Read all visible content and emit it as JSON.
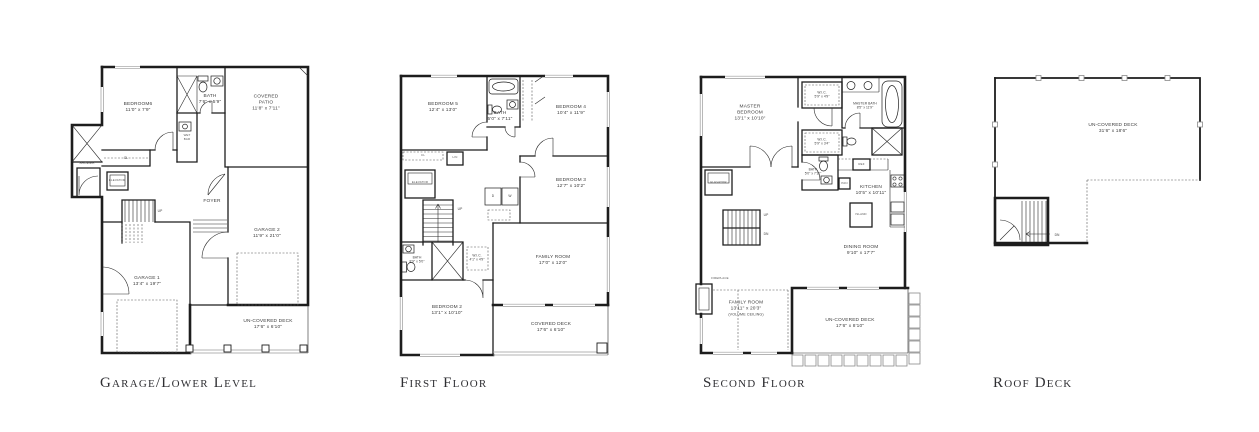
{
  "plans": {
    "garage_lower": {
      "title": "Garage/Lower Level",
      "rooms": {
        "bedroom6": {
          "name": "BEDROOM6",
          "dims": "11'0\" x 7'9\""
        },
        "bath": {
          "name": "BATH",
          "dims": "7'6\" x 5'9\""
        },
        "covered_patio": {
          "name": "COVERED PATIO",
          "dims": "11'8\" x 7'11\""
        },
        "foyer": {
          "name": "FOYER"
        },
        "garage1": {
          "name": "GARAGE 1",
          "dims": "13'4\" x 19'7\""
        },
        "garage2": {
          "name": "GARAGE 2",
          "dims": "11'9\" x 21'0\""
        },
        "uncovered_deck": {
          "name": "UN-COVERED DECK",
          "dims": "17'6\" x 6'10\""
        },
        "shower": {
          "name": "SHOWER"
        },
        "elevator": {
          "name": "ELEVATOR"
        },
        "wet_bar": {
          "name": "WET BAR"
        },
        "closet": {
          "name": "CL"
        },
        "up": {
          "name": "UP"
        }
      }
    },
    "first_floor": {
      "title": "First Floor",
      "rooms": {
        "bedroom5": {
          "name": "BEDROOM 5",
          "dims": "12'4\" x 13'0\""
        },
        "bath_upper": {
          "name": "BATH",
          "dims": "5'0\" x 7'11\""
        },
        "bedroom4": {
          "name": "BEDROOM 4",
          "dims": "10'4\" x 11'9\""
        },
        "bedroom3": {
          "name": "BEDROOM 3",
          "dims": "12'7\" x 10'2\""
        },
        "bedroom2": {
          "name": "BEDROOM 2",
          "dims": "13'1\" x 10'10\""
        },
        "family_room": {
          "name": "FAMILY ROOM",
          "dims": "17'0\" x 12'0\""
        },
        "covered_deck": {
          "name": "COVERED DECK",
          "dims": "17'6\" x 6'10\""
        },
        "bath_lower": {
          "name": "BATH",
          "dims": "8'9\" x 5'0\""
        },
        "wic": {
          "name": "W.I.C.",
          "dims": "4'1\" x 4'9\""
        },
        "linen": {
          "name": "LIN"
        },
        "closet": {
          "name": "CL"
        },
        "elevator": {
          "name": "ELEVATOR"
        },
        "dryer": {
          "name": "D"
        },
        "washer": {
          "name": "W"
        },
        "up": {
          "name": "UP"
        }
      }
    },
    "second_floor": {
      "title": "Second Floor",
      "rooms": {
        "master_bedroom": {
          "name": "MASTER BEDROOM",
          "dims": "13'1\" x 10'10\""
        },
        "wic1": {
          "name": "W.I.C.",
          "dims": "5'9\" x 4'9\""
        },
        "master_bath": {
          "name": "MASTER BATH",
          "dims": "8'5\" x 11'9\""
        },
        "wic2": {
          "name": "W.I.C.",
          "dims": "5'9\" x 3'4\""
        },
        "bath": {
          "name": "BATH",
          "dims": "5'0\" x 7'11\""
        },
        "kitchen": {
          "name": "KITCHEN",
          "dims": "10'5\" x 10'11\""
        },
        "island": {
          "name": "ISLAND"
        },
        "fridge": {
          "name": "REF"
        },
        "pantry": {
          "name": "PAN"
        },
        "dining_room": {
          "name": "DINING ROOM",
          "dims": "9'10\" x 17'7\""
        },
        "family_room": {
          "name": "FAMILY ROOM",
          "dims": "13'11\" x 20'3\"",
          "note": "(VOLUME CEILING)"
        },
        "fireplace": {
          "name": "FIREPLACE"
        },
        "uncovered_deck": {
          "name": "UN-COVERED DECK",
          "dims": "17'6\" x 8'10\""
        },
        "elevator": {
          "name": "ELEVATOR"
        },
        "up": {
          "name": "UP"
        },
        "dn": {
          "name": "DN"
        }
      }
    },
    "roof_deck": {
      "title": "Roof Deck",
      "rooms": {
        "uncovered_deck": {
          "name": "UN-COVERED DECK",
          "dims": "31'6\" x 18'6\""
        },
        "dn": {
          "name": "DN"
        }
      }
    }
  }
}
